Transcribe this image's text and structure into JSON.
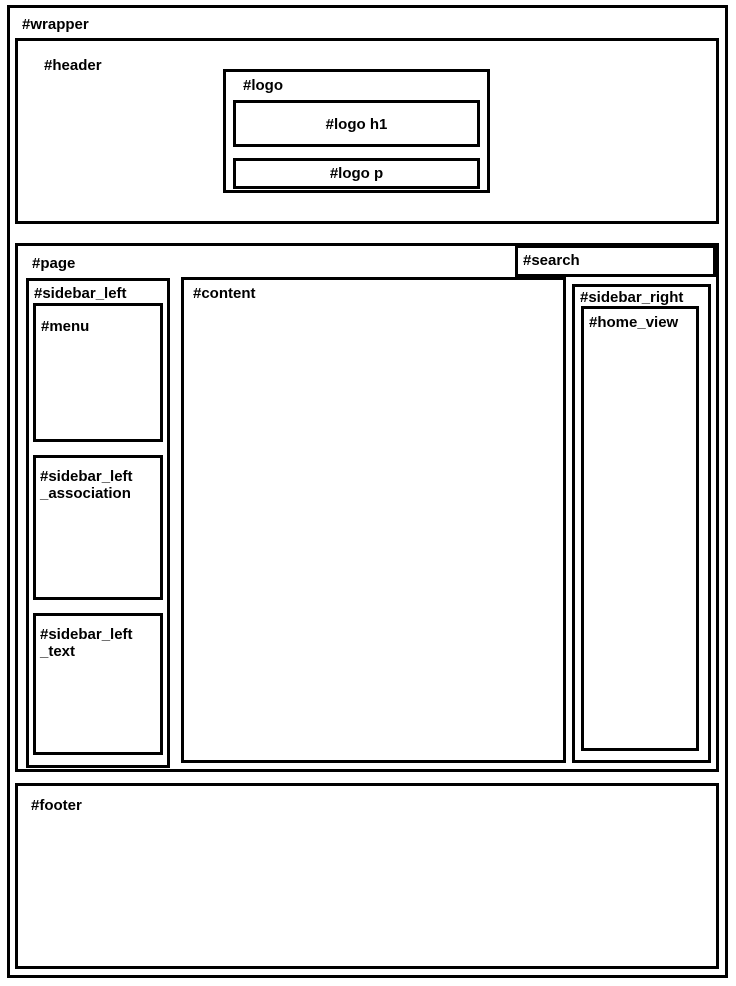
{
  "diagram": {
    "wrapper_label": "#wrapper",
    "header_label": "#header",
    "logo_label": "#logo",
    "logo_h1_label": "#logo h1",
    "logo_p_label": "#logo p",
    "page_label": "#page",
    "search_label": "#search",
    "sidebar_left_label": "#sidebar_left",
    "menu_label": "#menu",
    "sidebar_left_association": {
      "line1": "#sidebar_left",
      "line2": "_association"
    },
    "sidebar_left_text": {
      "line1": "#sidebar_left",
      "line2": "_text"
    },
    "content_label": "#content",
    "sidebar_right_label": "#sidebar_right",
    "home_view_label": "#home_view",
    "footer_label": "#footer"
  },
  "colors": {
    "border": "#000000",
    "background": "#ffffff",
    "text": "#000000"
  }
}
